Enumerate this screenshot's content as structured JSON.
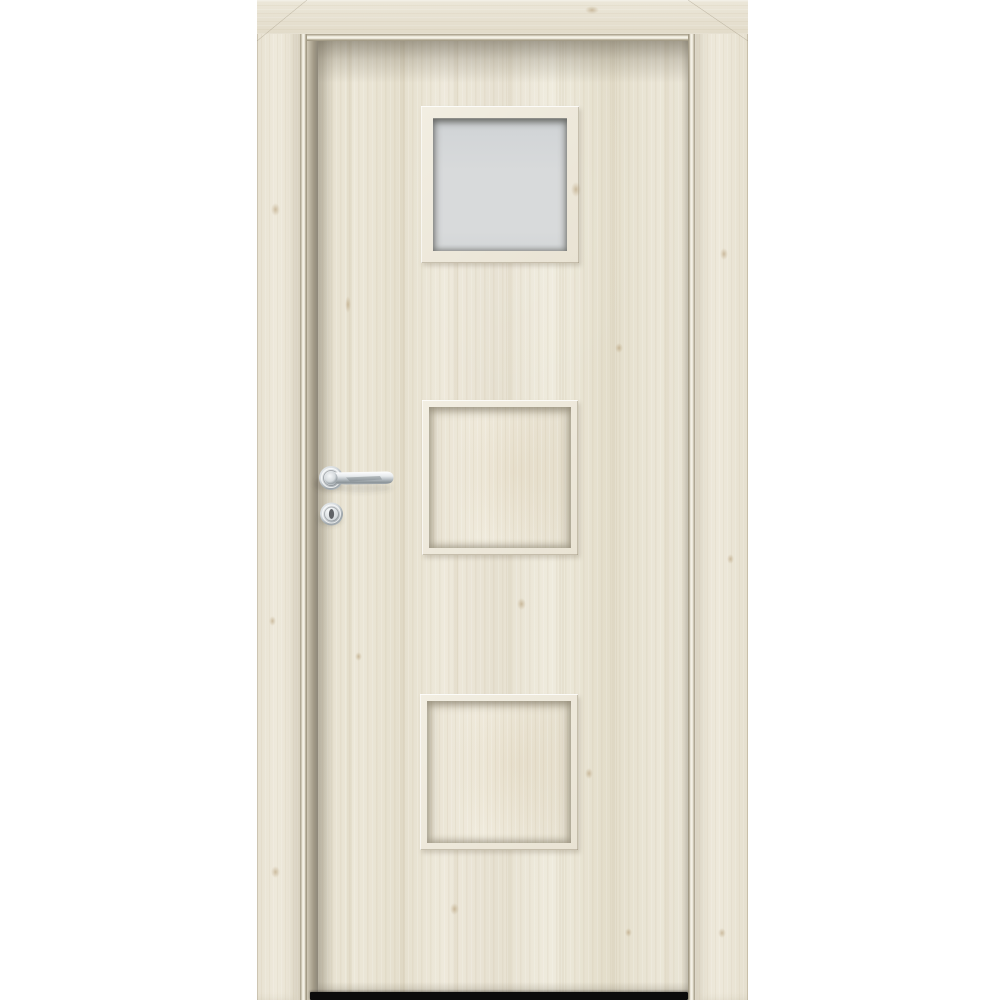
{
  "page": {
    "title": "Interior door product photo",
    "background": "#ffffff"
  },
  "door": {
    "type": "interior-door-with-frame",
    "finish": "light-scandinavian-oak",
    "panels": [
      {
        "position": "top",
        "kind": "frosted-glass-square"
      },
      {
        "position": "middle",
        "kind": "recessed-wood-square"
      },
      {
        "position": "bottom",
        "kind": "recessed-wood-square"
      }
    ],
    "hardware": [
      {
        "name": "lever-handle",
        "finish": "polished-chrome",
        "side": "left"
      },
      {
        "name": "keyhole-escutcheon",
        "finish": "polished-chrome"
      }
    ],
    "under_door_gap_visible": true
  },
  "colors": {
    "bg": "#ffffff",
    "wood_base": "#e9e4d6",
    "wood_light": "#f1ecdf",
    "wood_dark": "#e0d9c6",
    "wood_knot": "#c3ae88",
    "molding_hi": "#f8f5ec",
    "molding_lo": "#a39b86",
    "reveal_dark": "#8d8779",
    "glass": "#d8dadb",
    "glass_dark": "#c7cbcd",
    "glass_edge": "#8e8e89",
    "chrome_hi": "#f7f9fa",
    "chrome_mid": "#c2c8cc",
    "chrome_lo": "#858d92",
    "under_door_gap": "#0b0b0b"
  }
}
